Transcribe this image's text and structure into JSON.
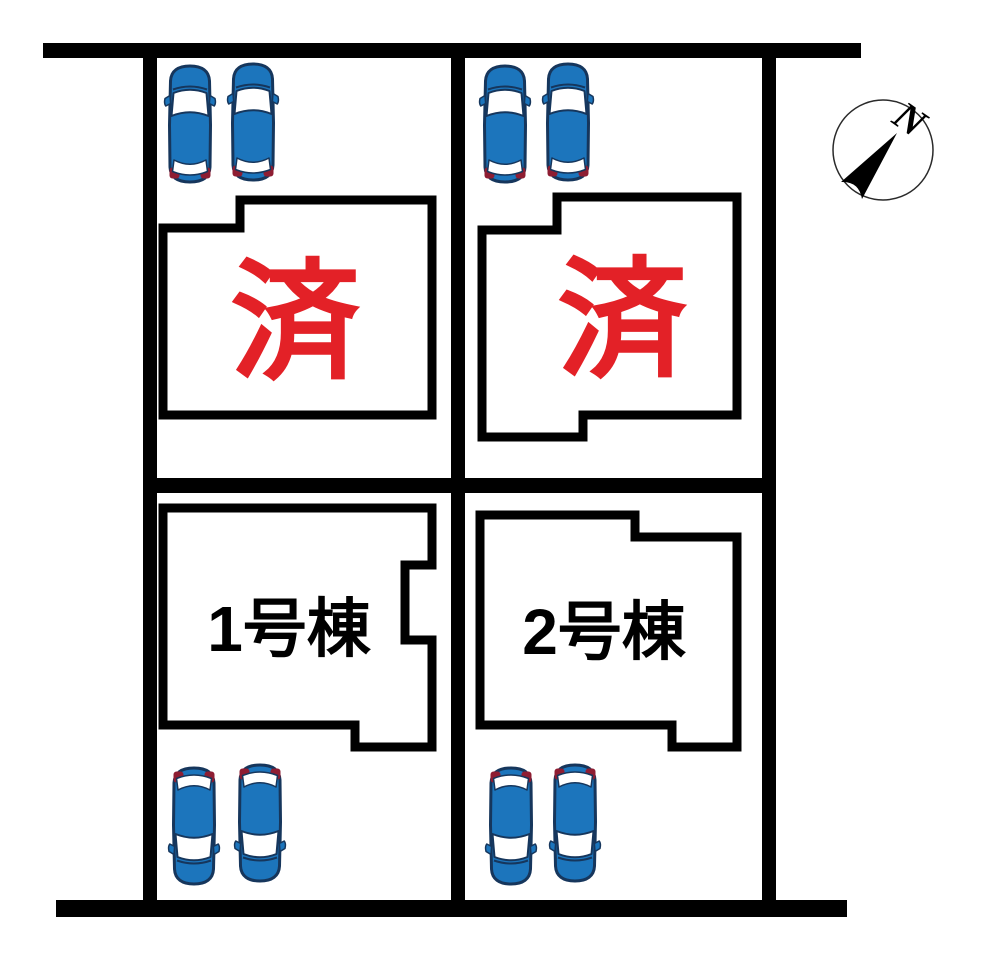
{
  "plan": {
    "lots": [
      {
        "name": "top-left",
        "label": "済",
        "status": "sold",
        "parked_cars": 2
      },
      {
        "name": "top-right",
        "label": "済",
        "status": "sold",
        "parked_cars": 2
      },
      {
        "name": "bottom-left",
        "label": "1号棟",
        "status": "for-sale",
        "parked_cars": 2
      },
      {
        "name": "bottom-right",
        "label": "2号棟",
        "status": "for-sale",
        "parked_cars": 2
      }
    ],
    "compass": {
      "north_label": "N"
    },
    "icons": {
      "car": "car-top-view-icon",
      "compass": "compass-north-icon"
    },
    "colors": {
      "sold_label_red": "#e32127",
      "car_body_blue": "#1c75bc",
      "car_outline_navy": "#16365c",
      "car_taillight_maroon": "#8e1d32",
      "plan_line_black": "#000000",
      "background_white": "#ffffff"
    }
  }
}
